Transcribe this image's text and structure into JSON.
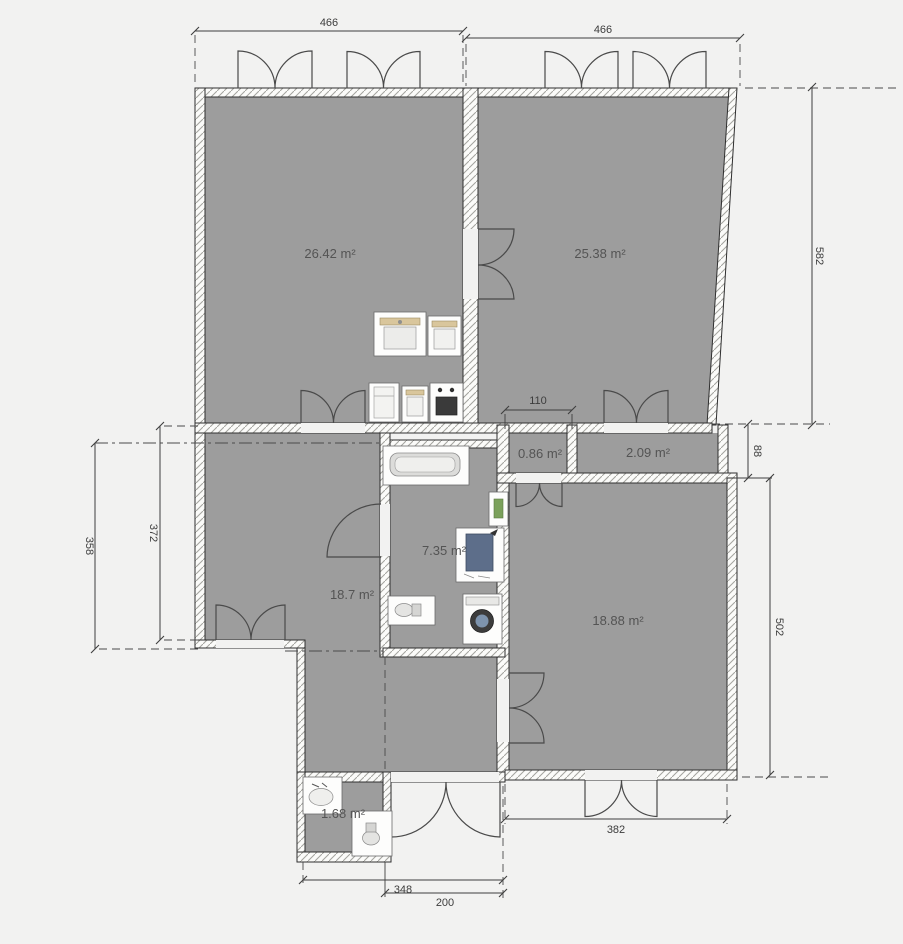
{
  "plan": {
    "background": "#f2f2f1",
    "room_fill": "#9d9d9d",
    "wall_fill": "#fbfbf9",
    "line_color": "#3f3f3f",
    "rooms": [
      {
        "name": "room-top-left",
        "label": "26.42 m²"
      },
      {
        "name": "room-top-right",
        "label": "25.38 m²"
      },
      {
        "name": "closet-small",
        "label": "0.86 m²"
      },
      {
        "name": "closet-wide",
        "label": "2.09 m²"
      },
      {
        "name": "bathroom",
        "label": "7.35 m²"
      },
      {
        "name": "room-mid-left",
        "label": "18.7 m²"
      },
      {
        "name": "room-bottom-right",
        "label": "18.88 m²"
      },
      {
        "name": "wc-small",
        "label": "1.68 m²"
      }
    ],
    "dimensions": {
      "top_left": "466",
      "top_right": "466",
      "right_upper": "582",
      "closet_width": "110",
      "closet_height": "88",
      "right_lower": "502",
      "left_outer": "358",
      "left_inner": "372",
      "bottom_right": "382",
      "bottom_outer": "348",
      "bottom_door": "200"
    },
    "furniture": [
      "kitchen-sink-cabinet",
      "kitchen-wall-cabinet",
      "fridge",
      "kitchen-base-cabinet",
      "stove",
      "bathtub",
      "radiator",
      "water-heater",
      "toilet",
      "washing-machine",
      "hand-basin",
      "toilet-small"
    ]
  }
}
